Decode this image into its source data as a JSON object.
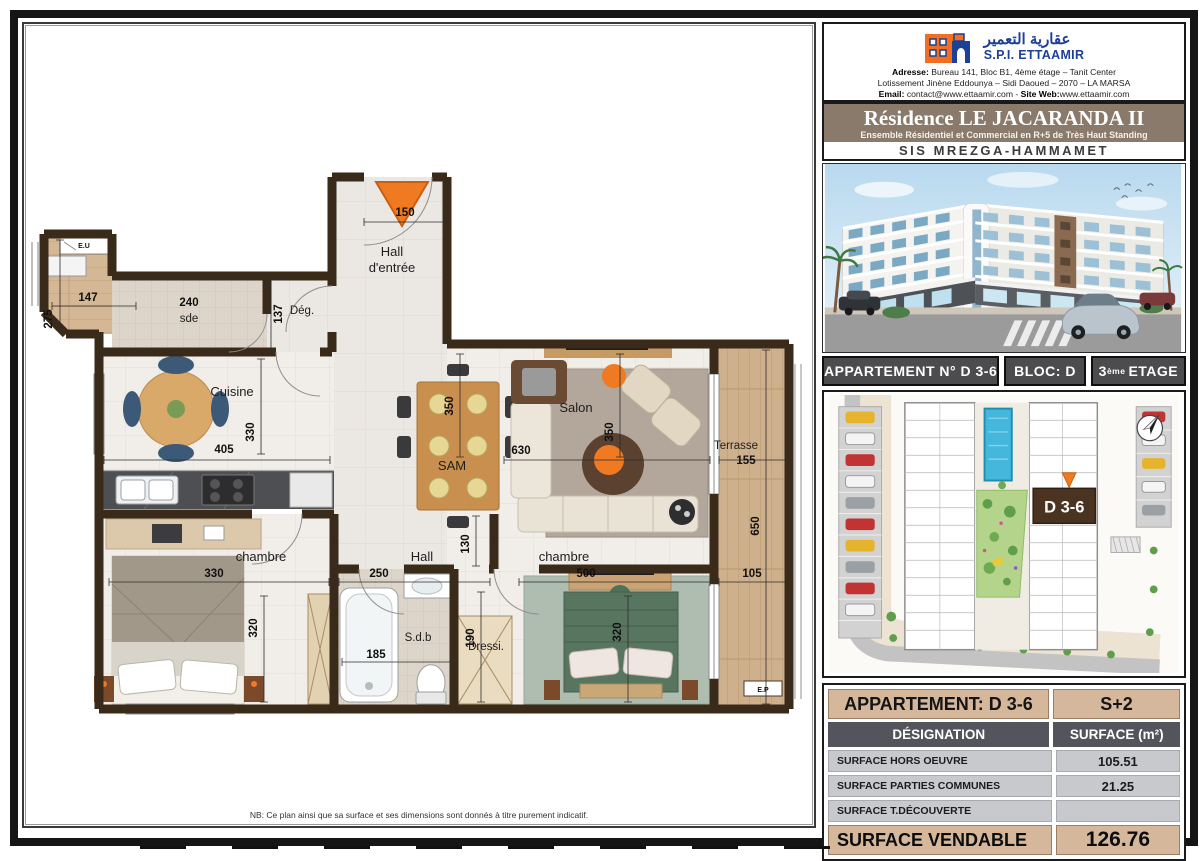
{
  "header": {
    "arabic_name": "عقارية التعمير",
    "company": "S.P.I. ETTAAMIR",
    "address_label": "Adresse:",
    "address1": "Bureau 141, Bloc B1, 4ème étage – Tanit Center",
    "address2": "Lotissement Jinène Eddounya – Sidi Daoued – 2070 – LA MARSA",
    "email_label": "Email:",
    "email": "contact@www.ettaamir.com",
    "separator": " - ",
    "site_label": "Site Web:",
    "site": "www.ettaamir.com"
  },
  "banner": {
    "title": "Résidence LE JACARANDA II",
    "subtitle": "Ensemble Résidentiel et Commercial en R+5 de Très Haut Standing",
    "location": "SIS MREZGA-HAMMAMET"
  },
  "apartment_bar": {
    "apartment": "APPARTEMENT N° D 3-6",
    "bloc": "BLOC: D",
    "etage_num": "3",
    "etage_sup": "ème",
    "etage_rest": "ETAGE"
  },
  "site_plan": {
    "unit": "D 3-6"
  },
  "surface_table": {
    "title": "APPARTEMENT: D 3-6",
    "type": "S+2",
    "col_designation": "DÉSIGNATION",
    "col_surface": "SURFACE (m²)",
    "rows": [
      {
        "label": "SURFACE HORS OEUVRE",
        "value": "105.51"
      },
      {
        "label": "SURFACE PARTIES COMMUNES",
        "value": "21.25"
      },
      {
        "label": "SURFACE T.DÉCOUVERTE",
        "value": ""
      }
    ],
    "total_label": "SURFACE VENDABLE",
    "total_value": "126.76"
  },
  "floor_plan": {
    "rooms": {
      "entry_hall_1": "Hall",
      "entry_hall_2": "d'entrée",
      "deg": "Dég.",
      "sde_num": "240",
      "sde": "sde",
      "cuisine": "Cuisine",
      "sam": "SAM",
      "salon": "Salon",
      "terrasse": "Terrasse",
      "chambre1": "chambre",
      "hall": "Hall",
      "chambre2": "chambre",
      "sdb": "S.d.b",
      "dressing": "Dressi."
    },
    "dims": {
      "entry": "150",
      "balc_w": "147",
      "balc_h": "275",
      "sde_h": "137",
      "cuisine_w": "405",
      "cuisine_h": "330",
      "sam_h": "350",
      "salon_w": "630",
      "salon_h": "350",
      "terrasse_w": "155",
      "terrasse_h": "650",
      "terrasse_s": "105",
      "ch1_w": "330",
      "hall_w": "250",
      "hall_h": "130",
      "ch2_w": "500",
      "ch1_h": "320",
      "sdb_w": "185",
      "sdb_h": "190",
      "ch2_h": "320"
    },
    "markers": {
      "eu": "E.U",
      "ep": "E.P"
    },
    "note": "NB: Ce plan ainsi que sa surface et ses dimensions sont donnés à titre purement indicatif."
  }
}
